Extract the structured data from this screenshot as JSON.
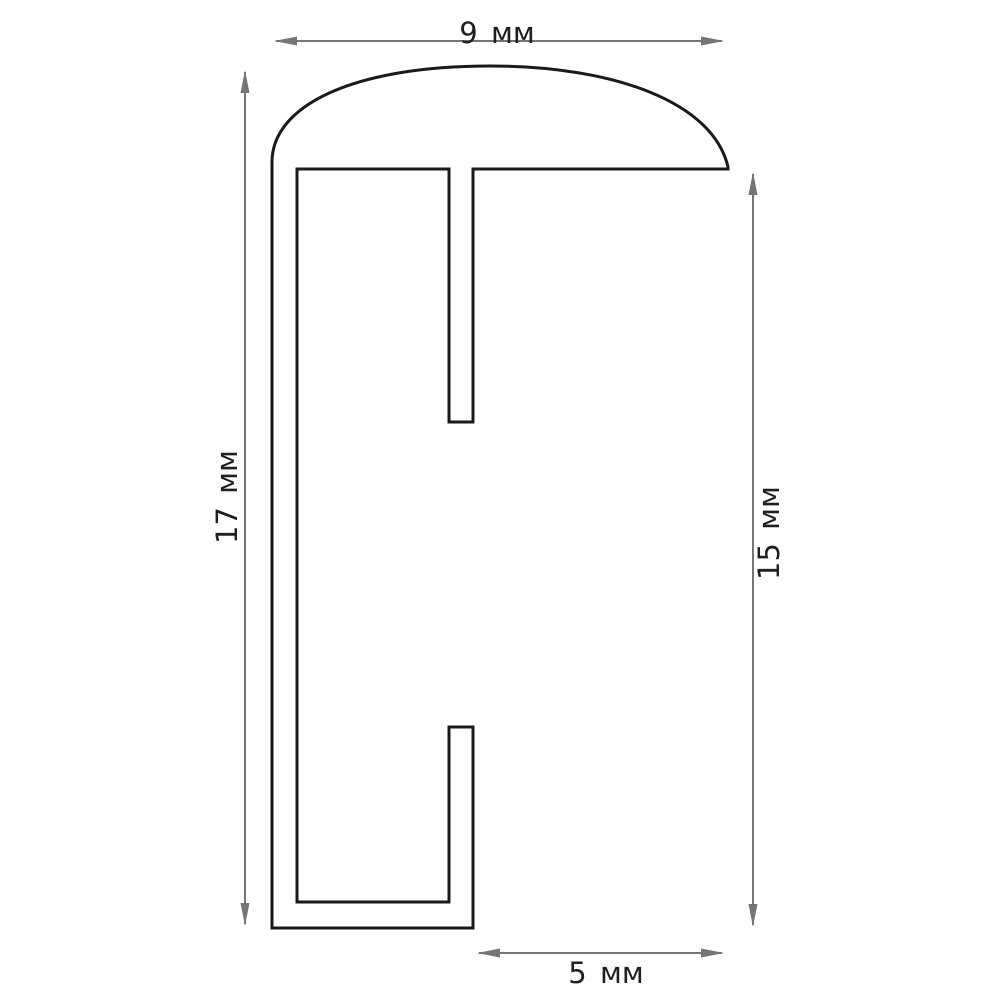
{
  "drawing": {
    "type": "technical-cross-section",
    "unit": "мм",
    "background_color": "#ffffff",
    "line_color": "#1a1a1a",
    "dimension_color": "#757575",
    "text_color": "#1f1f1f",
    "dimensions": {
      "top_width": {
        "value": 9,
        "unit": "мм",
        "label": "9 мм",
        "orientation": "horizontal"
      },
      "left_height": {
        "value": 17,
        "unit": "мм",
        "label": "17 мм",
        "orientation": "vertical"
      },
      "right_height": {
        "value": 15,
        "unit": "мм",
        "label": "15 мм",
        "orientation": "vertical"
      },
      "bottom_width": {
        "value": 5,
        "unit": "мм",
        "label": "5 мм",
        "orientation": "horizontal"
      }
    }
  }
}
